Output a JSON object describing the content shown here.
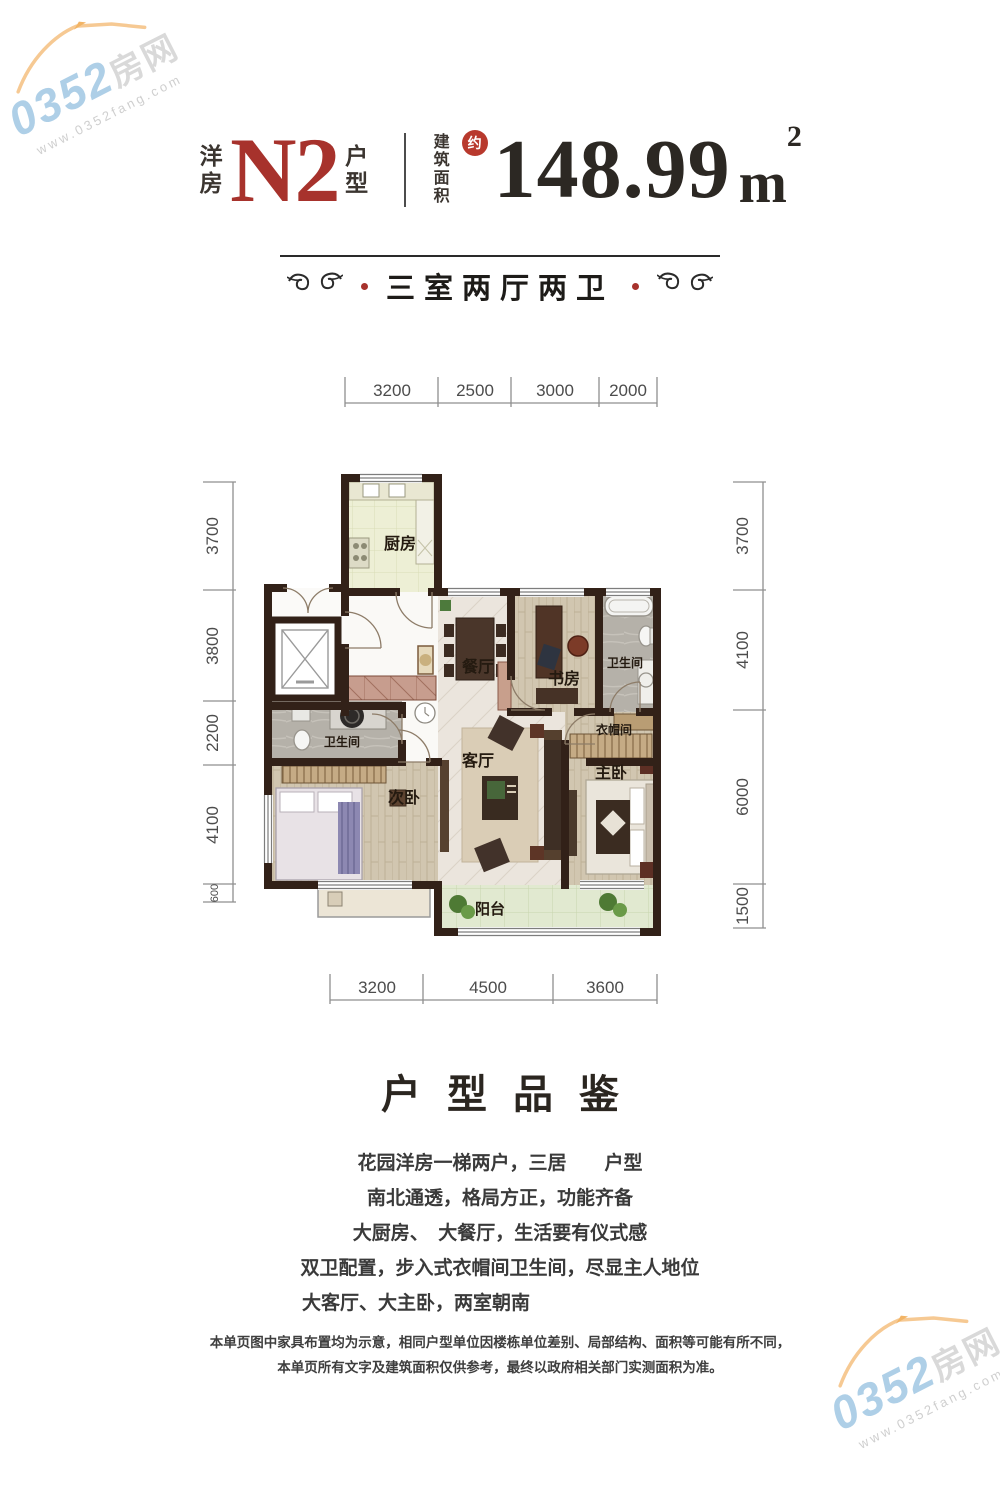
{
  "watermark": {
    "number": "0352",
    "suffix": "房网",
    "url": "www.0352fang.com"
  },
  "header": {
    "series": "洋房",
    "code": "N2",
    "type_suffix": "户型",
    "area_label": "建筑面积",
    "approx_badge": "约",
    "area_value": "148.99",
    "area_unit": "m",
    "area_exponent": "2"
  },
  "banner": {
    "layout_text": "三室两厅两卫"
  },
  "plan": {
    "dims_top": [
      "3200",
      "2500",
      "3000",
      "2000"
    ],
    "dims_bottom": [
      "3200",
      "4500",
      "3600"
    ],
    "dims_left": [
      "3700",
      "3800",
      "2200",
      "4100",
      "600"
    ],
    "dims_right": [
      "3700",
      "4100",
      "6000",
      "1500"
    ],
    "rooms": {
      "kitchen": "厨房",
      "dining": "餐厅",
      "study": "书房",
      "bath_upper": "卫生间",
      "bath_lower": "卫生间",
      "cloakroom": "衣帽间",
      "living": "客厅",
      "bedroom_second": "次卧",
      "bedroom_master": "主卧",
      "balcony": "阳台"
    }
  },
  "section": {
    "title": "户型品鉴",
    "lines": [
      "花园洋房一梯两户，三居　　户型",
      "南北通透，格局方正，功能齐备",
      "大厨房、　大餐厅，生活要有仪式感",
      "双卫配置，步入式衣帽间卫生间，尽显主人地位",
      "大客厅、大主卧，两室朝南"
    ]
  },
  "disclaimer": {
    "line1": "本单页图中家具布置均为示意，相同户型单位因楼栋单位差别、局部结构、面积等可能有所不同，",
    "line2": "本单页所有文字及建筑面积仅供参考，最终以政府相关部门实测面积为准。"
  }
}
